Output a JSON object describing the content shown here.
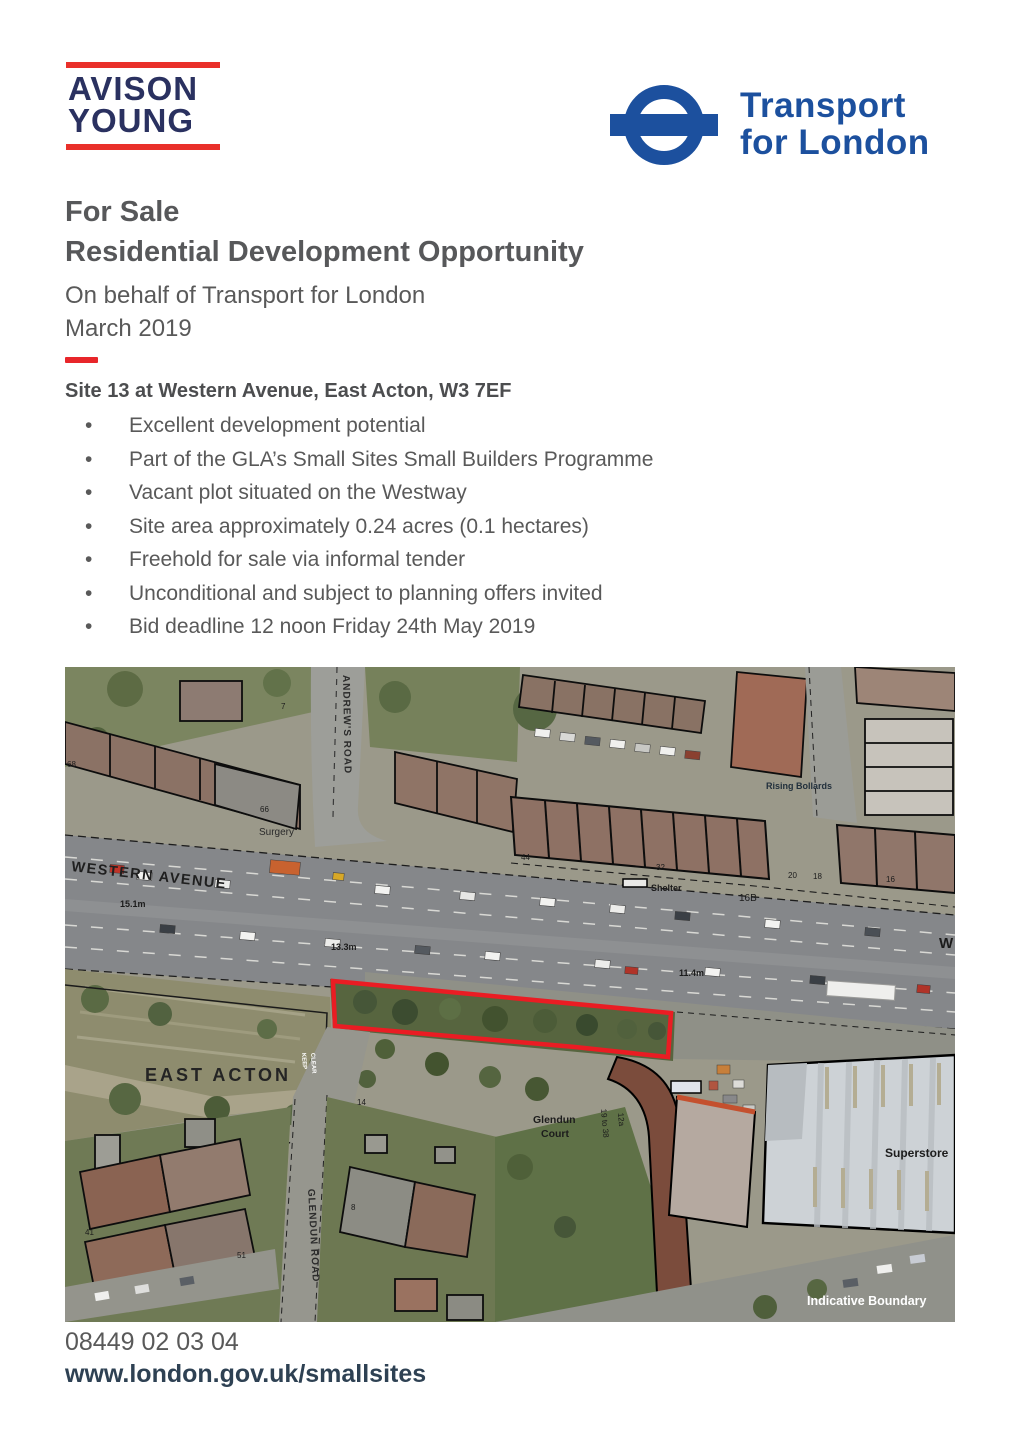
{
  "brand": {
    "avison_young": {
      "line1": "AVISON",
      "line2": "YOUNG"
    },
    "tfl": {
      "line1": "Transport",
      "line2": "for London"
    }
  },
  "colors": {
    "ay_navy": "#2a3160",
    "ay_red": "#e9302a",
    "tfl_blue": "#1c509e",
    "accent_red": "#e8262a",
    "boundary_red": "#ea1c23",
    "text_gray": "#595959",
    "footer_dark": "#2e4153"
  },
  "title": {
    "for_sale": "For Sale",
    "main": "Residential Development Opportunity",
    "on_behalf": "On behalf of Transport for London",
    "date": "March 2019"
  },
  "site": {
    "heading": "Site 13 at Western Avenue, East Acton, W3 7EF",
    "bullets": [
      "Excellent development potential",
      "Part of the GLA’s Small Sites Small Builders Programme",
      "Vacant plot situated on the Westway",
      "Site area approximately 0.24 acres (0.1 hectares)",
      "Freehold for sale via informal tender",
      "Unconditional and subject to planning offers invited",
      "Bid deadline 12 noon Friday 24th May 2019"
    ]
  },
  "map": {
    "labels": {
      "western_avenue": "WESTERN AVENUE",
      "andrews_road": "ANDREW'S ROAD",
      "glendun_road": "GLENDUN ROAD",
      "east_acton": "EAST ACTON",
      "surgery": "Surgery",
      "rising_bollards": "Rising Bollards",
      "shelter": "Shelter",
      "plot_16b": "16B",
      "glendun_court_line1": "Glendun",
      "glendun_court_line2": "Court",
      "flats_19_38": "19 to 38",
      "no_12a": "12a",
      "superstore": "Superstore",
      "indicative_boundary": "Indicative Boundary",
      "dim_15_1": "15.1m",
      "dim_13_3": "13.3m",
      "dim_11_4": "11.4m",
      "west_partial": "W",
      "keep": "KEEP",
      "clear": "CLEAR",
      "no_68": "68",
      "no_66": "66",
      "no_7": "7",
      "no_44": "44",
      "no_32": "32",
      "no_20": "20",
      "no_18": "18",
      "no_16": "16",
      "no_41": "41",
      "no_51": "51",
      "no_14": "14",
      "no_8": "8"
    }
  },
  "footer": {
    "phone": "08449 02 03 04",
    "website": "www.london.gov.uk/smallsites"
  }
}
